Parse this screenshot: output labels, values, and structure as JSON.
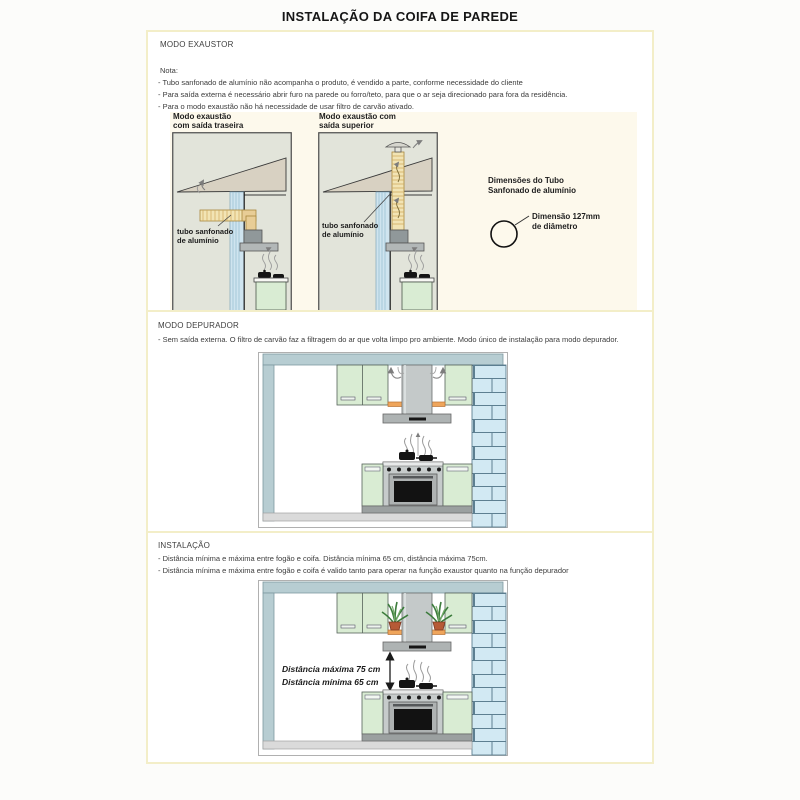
{
  "title": "INSTALAÇÃO DA COIFA DE PAREDE",
  "exaustor": {
    "heading": "MODO EXAUSTOR",
    "nota_label": "Nota:",
    "notes": [
      "- Tubo sanfonado de alumínio não acompanha o produto, é vendido a parte, conforme necessidade do cliente",
      "- Para saída externa é necessário abrir furo na parede ou forro/teto, para que o ar seja direcionado para fora da residência.",
      "- Para o modo exaustão não há necessidade de usar filtro de carvão ativado."
    ],
    "diagram_rear": {
      "title_line1": "Modo exaustão",
      "title_line2": "com saída traseira",
      "tube_label_line1": "tubo sanfonado",
      "tube_label_line2": "de alumínio"
    },
    "diagram_top": {
      "title_line1": "Modo exaustão com",
      "title_line2": "saída superior",
      "tube_label_line1": "tubo sanfonado",
      "tube_label_line2": "de alumínio"
    },
    "tube_dimensions": {
      "heading_line1": "Dimensões do Tubo",
      "heading_line2": "Sanfonado de alumínio",
      "label_line1": "Dimensão 127mm",
      "label_line2": "de diâmetro"
    }
  },
  "depurador": {
    "heading": "MODO DEPURADOR",
    "note": "- Sem saída externa. O filtro de carvão faz a filtragem do ar que volta limpo pro ambiente. Modo único de instalação para modo depurador."
  },
  "instalacao": {
    "heading": "INSTALAÇÃO",
    "notes": [
      "- Distância mínima e máxima entre fogão e coifa. Distância mínima 65 cm, distância máxima 75cm.",
      "- Distância mínima e máxima entre fogão e coifa é valido tanto para operar na função exaustor quanto na função depurador"
    ],
    "distance_max_label": "Distância máxima 75 cm",
    "distance_min_label": "Distância mínima 65 cm"
  },
  "colors": {
    "section_border": "#f3eec8",
    "panel_cream": "#fdf9ec",
    "diagram_bg": "#e2e4da",
    "roof_tan": "#d8d1c2",
    "wall_blue": "#cfe4ef",
    "tube_yellow": "#f2e4b4",
    "cabinet_green": "#d9ecd3",
    "brick_blue": "#d2e9f3",
    "shelf_orange": "#efa55b",
    "ceiling_gray_blue": "#b7cdd2",
    "text_dark": "#3c3c3c"
  }
}
